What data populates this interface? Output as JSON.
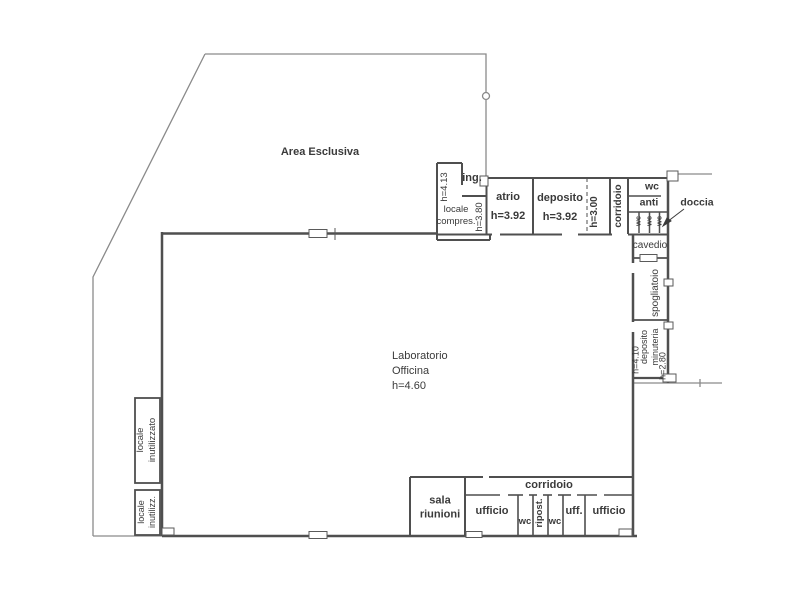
{
  "drawing": {
    "type": "floor-plan",
    "background": "#ffffff",
    "wall_color": "#4f4f4f",
    "boundary_color": "#8a8a8a",
    "text_color": "#3a3a3a"
  },
  "areas": {
    "area_esclusiva": "Area Esclusiva",
    "ingresso": "ing.",
    "h_4_13": "h=4.13",
    "locale_compressore": "locale\ncompres.",
    "h_3_80": "h=3.80",
    "atrio": "atrio\nh=3.92",
    "deposito": "deposito\nh=3.92",
    "h_3_00": "h=3.00",
    "corridoio_nord": "corridoio",
    "wc_nord": "wc",
    "anti": "anti",
    "wc_stall_1": "wc",
    "wc_stall_2": "wc",
    "wc_stall_3": "wc",
    "doccia": "doccia",
    "cavedio": "cavedio",
    "spogliatoio": "spogliatoio",
    "deposito_minuteria": "deposito\nminuteria",
    "h_4_10": "h=4.10",
    "h_2_80": "h=2.80",
    "laboratorio": "Laboratorio\nOfficina\nh=4.60",
    "corridoio_sud": "corridoio",
    "sala_riunioni": "sala\nriunioni",
    "ufficio_1": "ufficio",
    "wc_sud_1": "wc",
    "ripostiglio": "ripost.",
    "wc_sud_2": "wc",
    "uff": "uff.",
    "ufficio_2": "ufficio",
    "locale_inutilizzato": "locale\ninutilizzato",
    "locale_inutilizz": "locale\ninutilizz."
  }
}
